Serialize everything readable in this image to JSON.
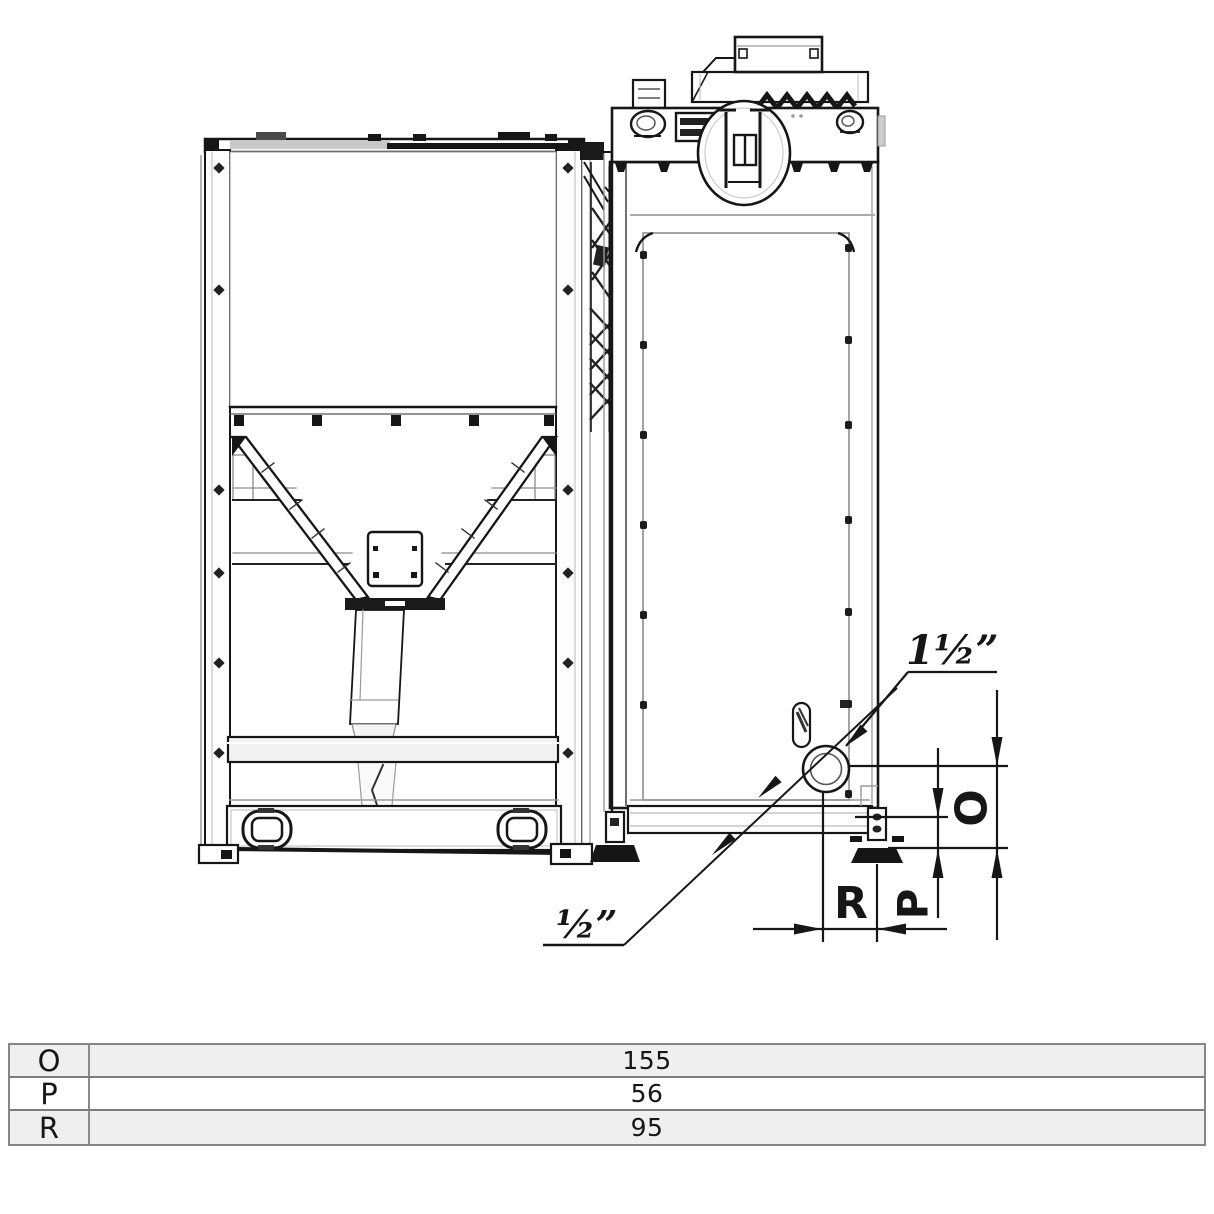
{
  "drawing": {
    "annotations": {
      "fitting_top_label": "1½”",
      "fitting_bottom_label": "½”",
      "dim_o_label": "O",
      "dim_p_label": "P",
      "dim_r_label": "R"
    }
  },
  "table": {
    "rows": [
      {
        "label": "O",
        "value": "155"
      },
      {
        "label": "P",
        "value": "56"
      },
      {
        "label": "R",
        "value": "95"
      }
    ]
  },
  "colors": {
    "line": "#161616",
    "secondary": "#9a9a9a",
    "row_shaded": "#efefef",
    "table_border": "#868686"
  }
}
